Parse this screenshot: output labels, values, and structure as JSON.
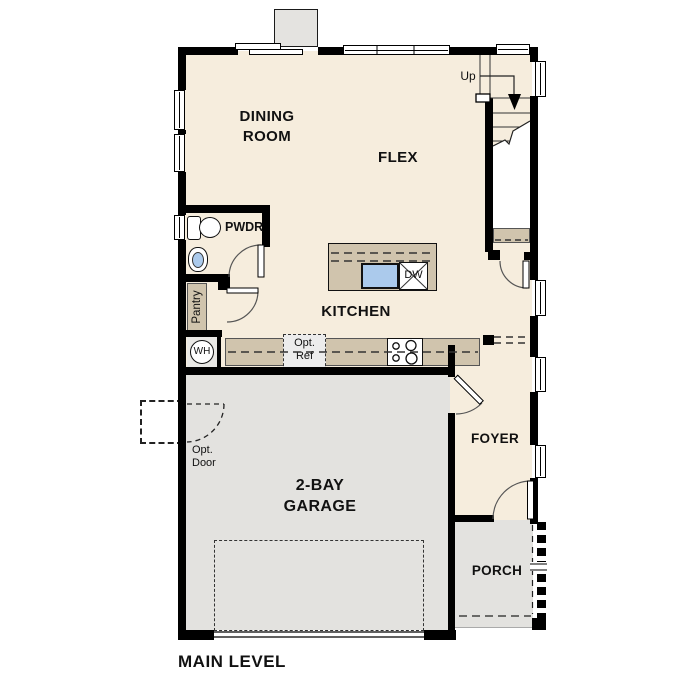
{
  "plan": {
    "title": "MAIN LEVEL",
    "rooms": {
      "dining_line1": "DINING",
      "dining_line2": "ROOM",
      "flex": "FLEX",
      "kitchen": "KITCHEN",
      "powder": "PWDR",
      "pantry": "Pantry",
      "garage_line1": "2-BAY",
      "garage_line2": "GARAGE",
      "foyer": "FOYER",
      "porch": "PORCH"
    },
    "annotations": {
      "up": "Up",
      "water_heater": "WH",
      "dishwasher": "DW",
      "opt_ref_line1": "Opt.",
      "opt_ref_line2": "Ref",
      "opt_door_line1": "Opt.",
      "opt_door_line2": "Door"
    },
    "colors": {
      "floor": "#f6eddd",
      "garage_floor": "#e3e2df",
      "counter": "#d0c4ad",
      "sink": "#abcaec",
      "wall": "#000000"
    }
  }
}
